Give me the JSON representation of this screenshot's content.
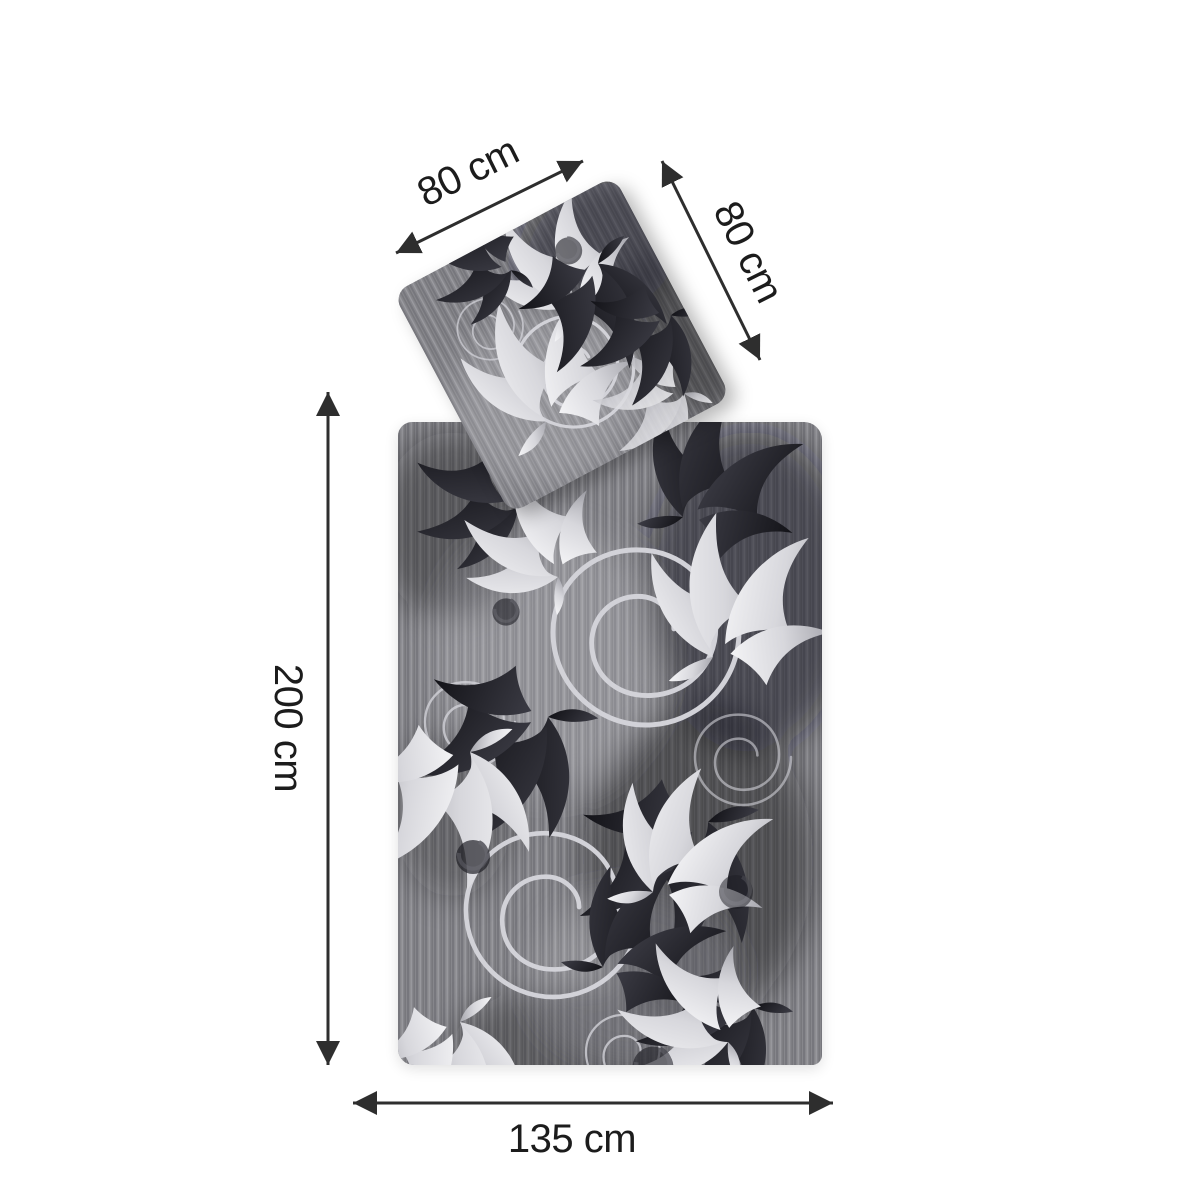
{
  "labels": {
    "pillow_width": "80 cm",
    "pillow_height": "80 cm",
    "duvet_length": "200 cm",
    "duvet_width": "135 cm"
  },
  "colors": {
    "arrow": "#2e2e2e",
    "label_text": "#1c1c1c",
    "fabric_base": "#87878c",
    "fabric_dark": "#17171d",
    "fabric_light": "#e9e9ec",
    "page_background": "#ffffff"
  }
}
